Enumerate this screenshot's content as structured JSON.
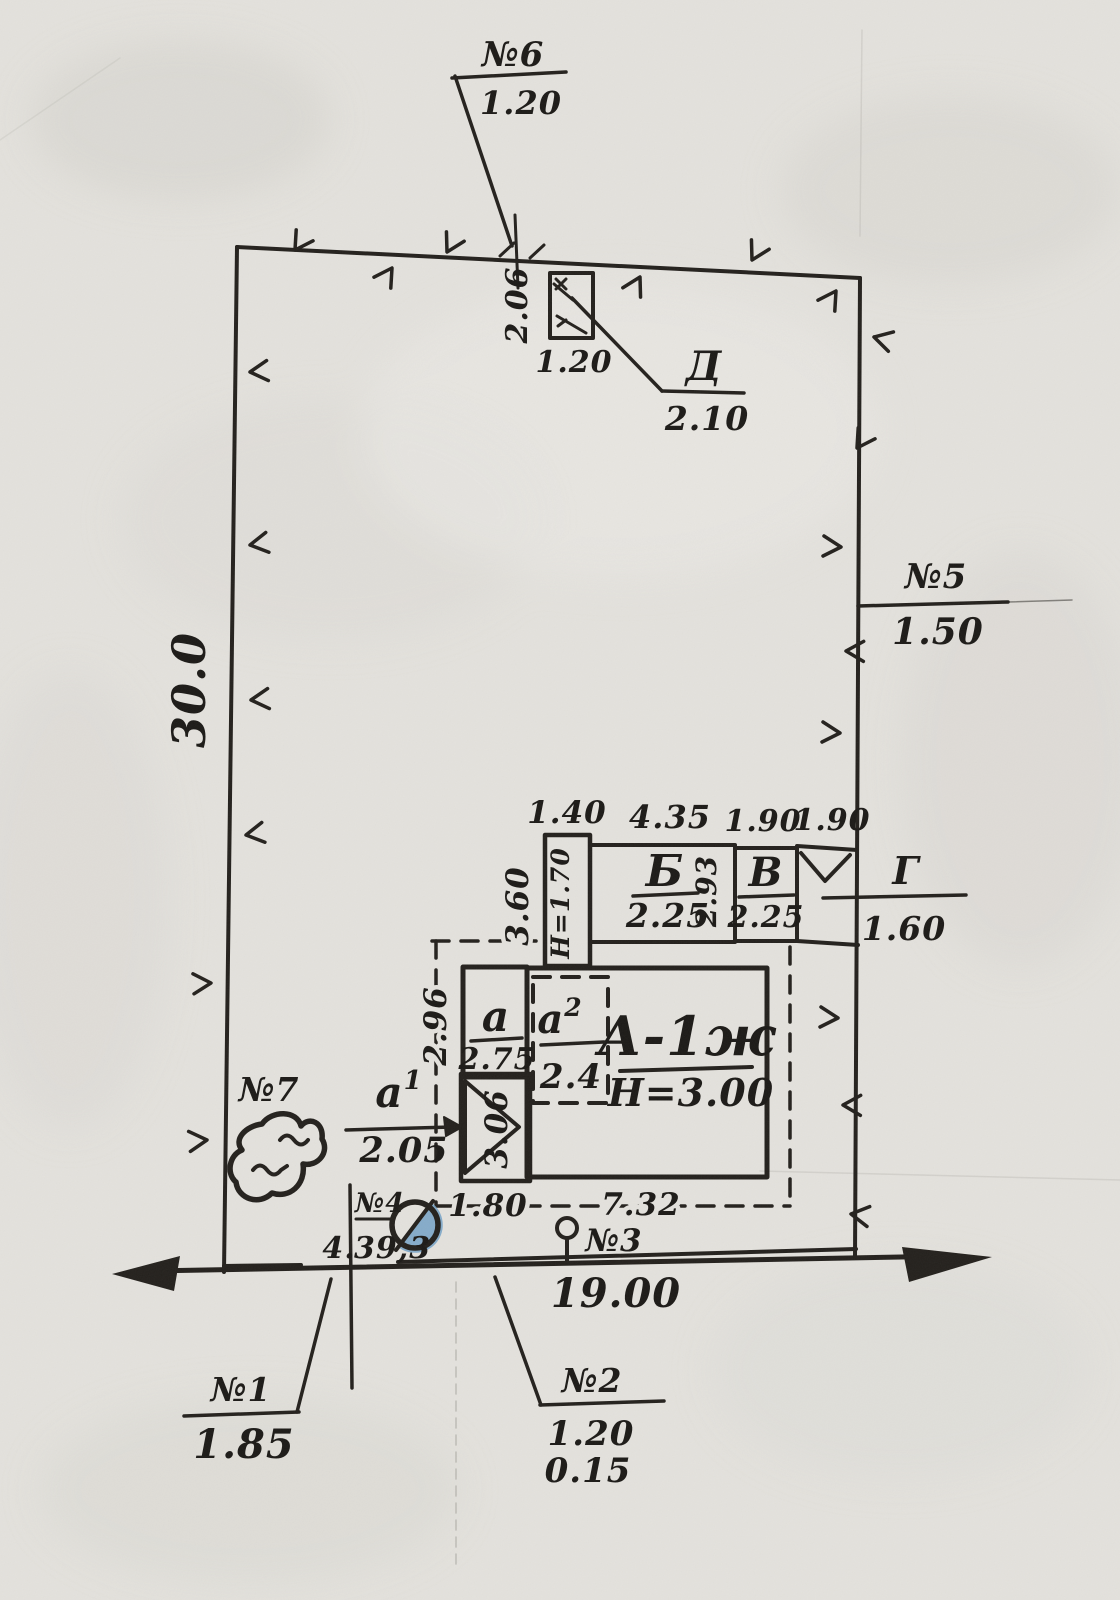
{
  "colors": {
    "paper": "#e4e2dd",
    "ink": "#24211d",
    "pink_building": "#e6c4cb",
    "yellow_building": "#d7c977",
    "gray_shed": "#a8a29b",
    "well_blue": "#7ba6c8"
  },
  "site": {
    "left_side": "30.0",
    "frontage": "19.00"
  },
  "points": {
    "n1": {
      "label": "№1",
      "value": "1.85"
    },
    "n2": {
      "label": "№2",
      "upper": "1.20",
      "lower": "0.15"
    },
    "n3": {
      "label": "№3"
    },
    "n4": {
      "label": "№4",
      "left": "4.",
      "value": "39,3"
    },
    "n5": {
      "label": "№5",
      "value": "1.50"
    },
    "n6": {
      "label": "№6",
      "value": "1.20"
    },
    "n7": {
      "label": "№7"
    }
  },
  "structures": {
    "house": {
      "label": "А-1ж",
      "height": "Н=3.00",
      "dim_bottom_left": "1.80",
      "dim_bottom_right": "7.32"
    },
    "annex_a": {
      "label": "а",
      "area": "2.75",
      "dim_left": "2.96"
    },
    "annex_a2": {
      "letter": "а",
      "sup": "2",
      "area": "2.4"
    },
    "porch_a1": {
      "letter": "а",
      "sup": "1",
      "value": "2.05",
      "dim_side": "3.06"
    },
    "vestibule": {
      "height": "Н=1.70",
      "dim_top": "1.40",
      "dim_left": "3.60"
    },
    "building_b": {
      "label": "Б",
      "area": "2.25",
      "dim_top": "4.35",
      "dim_right": "2.93"
    },
    "building_v": {
      "label": "В",
      "area": "2.25",
      "dim_top": "1.90"
    },
    "shed_g": {
      "label": "Г",
      "value": "1.60",
      "dim_top": "1.90"
    },
    "shed_d": {
      "label": "Д",
      "value": "2.10",
      "dim_width": "1.20",
      "dim_height": "2.06"
    }
  }
}
